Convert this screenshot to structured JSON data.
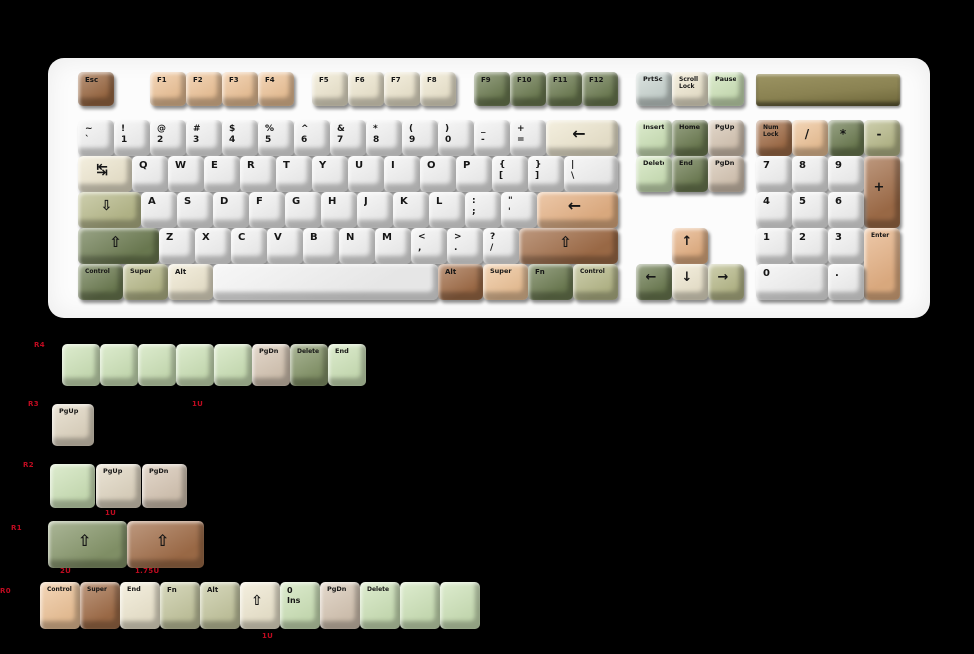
{
  "canvas": {
    "w": 974,
    "h": 654,
    "bg": "#000000"
  },
  "palette": {
    "white": "#f4f4f4",
    "cream": "#f0e9d2",
    "peach": "#efc59a",
    "tan": "#e6b285",
    "brown": "#a26e49",
    "dbrown": "#9c6a44",
    "dgreen": "#6f7e54",
    "mgreen": "#87976b",
    "sage": "#b9bb8c",
    "sage2": "#c7c9a2",
    "mint": "#cfe4ba",
    "taupe": "#d8c8b6",
    "sand": "#e2d8c4",
    "bluegray": "#ccd7d3",
    "legend": "#161616",
    "annotation_red": "#c00b20",
    "case": "#fcfcfc",
    "badge": "#8a8252"
  },
  "keyboard": {
    "case": {
      "x": 48,
      "y": 58,
      "w": 882,
      "h": 260
    },
    "badge": {
      "x": 756,
      "y": 74,
      "w": 144,
      "h": 32
    },
    "keys": [
      [
        78,
        72,
        36,
        34,
        "dbrown",
        "Esc",
        "",
        7,
        "esc"
      ],
      [
        150,
        72,
        36,
        34,
        "peach",
        "F1",
        "",
        7
      ],
      [
        186,
        72,
        36,
        34,
        "peach",
        "F2",
        "",
        7
      ],
      [
        222,
        72,
        36,
        34,
        "peach",
        "F3",
        "",
        7
      ],
      [
        258,
        72,
        36,
        34,
        "peach",
        "F4",
        "",
        7
      ],
      [
        312,
        72,
        36,
        34,
        "cream",
        "F5",
        "",
        7
      ],
      [
        348,
        72,
        36,
        34,
        "cream",
        "F6",
        "",
        7
      ],
      [
        384,
        72,
        36,
        34,
        "cream",
        "F7",
        "",
        7
      ],
      [
        420,
        72,
        36,
        34,
        "cream",
        "F8",
        "",
        7
      ],
      [
        474,
        72,
        36,
        34,
        "dgreen",
        "F9",
        "",
        7
      ],
      [
        510,
        72,
        36,
        34,
        "dgreen",
        "F10",
        "",
        7
      ],
      [
        546,
        72,
        36,
        34,
        "dgreen",
        "F11",
        "",
        7
      ],
      [
        582,
        72,
        36,
        34,
        "dgreen",
        "F12",
        "",
        7
      ],
      [
        636,
        72,
        36,
        34,
        "bluegray",
        "PrtSc",
        "",
        6.5,
        "print-screen"
      ],
      [
        672,
        72,
        36,
        34,
        "cream",
        "Scroll\nLock",
        "",
        6,
        "scroll-lock"
      ],
      [
        708,
        72,
        36,
        34,
        "mint",
        "Pause",
        "",
        6.5,
        "pause"
      ],
      [
        78,
        120,
        36,
        36,
        "white",
        "~\n`",
        "",
        9,
        "grave"
      ],
      [
        114,
        120,
        36,
        36,
        "white",
        "!\n1",
        "",
        9
      ],
      [
        150,
        120,
        36,
        36,
        "white",
        "@\n2",
        "",
        9
      ],
      [
        186,
        120,
        36,
        36,
        "white",
        "#\n3",
        "",
        9
      ],
      [
        222,
        120,
        36,
        36,
        "white",
        "$\n4",
        "",
        9
      ],
      [
        258,
        120,
        36,
        36,
        "white",
        "%\n5",
        "",
        9
      ],
      [
        294,
        120,
        36,
        36,
        "white",
        "^\n6",
        "",
        9
      ],
      [
        330,
        120,
        36,
        36,
        "white",
        "&\n7",
        "",
        9
      ],
      [
        366,
        120,
        36,
        36,
        "white",
        "*\n8",
        "",
        9
      ],
      [
        402,
        120,
        36,
        36,
        "white",
        "(\n9",
        "",
        9
      ],
      [
        438,
        120,
        36,
        36,
        "white",
        ")\n0",
        "",
        9
      ],
      [
        474,
        120,
        36,
        36,
        "white",
        "_\n-",
        "",
        9,
        "minus"
      ],
      [
        510,
        120,
        36,
        36,
        "white",
        "+\n=",
        "",
        9,
        "equals"
      ],
      [
        546,
        120,
        72,
        36,
        "cream",
        "←",
        "c",
        16,
        "backspace"
      ],
      [
        636,
        120,
        36,
        36,
        "mint",
        "Insert",
        "",
        6.5
      ],
      [
        672,
        120,
        36,
        36,
        "dgreen",
        "Home",
        "",
        6.5
      ],
      [
        708,
        120,
        36,
        36,
        "taupe",
        "PgUp",
        "",
        6.5
      ],
      [
        756,
        120,
        36,
        36,
        "brown",
        "Num\nLock",
        "",
        6,
        "num-lock"
      ],
      [
        792,
        120,
        36,
        36,
        "peach",
        "/",
        "c",
        12,
        "numpad-slash"
      ],
      [
        828,
        120,
        36,
        36,
        "dgreen",
        "*",
        "c",
        12,
        "numpad-star"
      ],
      [
        864,
        120,
        36,
        36,
        "sage",
        "-",
        "c",
        12,
        "numpad-minus"
      ],
      [
        78,
        156,
        54,
        36,
        "cream",
        "↹",
        "c",
        14,
        "tab"
      ],
      [
        132,
        156,
        36,
        36,
        "white",
        "Q",
        "",
        10
      ],
      [
        168,
        156,
        36,
        36,
        "white",
        "W",
        "",
        10
      ],
      [
        204,
        156,
        36,
        36,
        "white",
        "E",
        "",
        10
      ],
      [
        240,
        156,
        36,
        36,
        "white",
        "R",
        "",
        10
      ],
      [
        276,
        156,
        36,
        36,
        "white",
        "T",
        "",
        10
      ],
      [
        312,
        156,
        36,
        36,
        "white",
        "Y",
        "",
        10
      ],
      [
        348,
        156,
        36,
        36,
        "white",
        "U",
        "",
        10
      ],
      [
        384,
        156,
        36,
        36,
        "white",
        "I",
        "",
        10
      ],
      [
        420,
        156,
        36,
        36,
        "white",
        "O",
        "",
        10
      ],
      [
        456,
        156,
        36,
        36,
        "white",
        "P",
        "",
        10
      ],
      [
        492,
        156,
        36,
        36,
        "white",
        "{\n[",
        "",
        9,
        "lbracket"
      ],
      [
        528,
        156,
        36,
        36,
        "white",
        "}\n]",
        "",
        9,
        "rbracket"
      ],
      [
        564,
        156,
        54,
        36,
        "white",
        "|\n\\",
        "",
        9,
        "backslash"
      ],
      [
        636,
        156,
        36,
        36,
        "mint",
        "Delete",
        "",
        6.5
      ],
      [
        672,
        156,
        36,
        36,
        "dgreen",
        "End",
        "",
        6.5
      ],
      [
        708,
        156,
        36,
        36,
        "taupe",
        "PgDn",
        "",
        6.5
      ],
      [
        756,
        156,
        36,
        36,
        "white",
        "7",
        "",
        10,
        "numpad-7"
      ],
      [
        792,
        156,
        36,
        36,
        "white",
        "8",
        "",
        10,
        "numpad-8"
      ],
      [
        828,
        156,
        36,
        36,
        "white",
        "9",
        "",
        10,
        "numpad-9"
      ],
      [
        864,
        156,
        36,
        72,
        "brown",
        "+",
        "c",
        13,
        "numpad-plus"
      ],
      [
        78,
        192,
        63,
        36,
        "sage",
        "⇩",
        "c",
        14,
        "caps-lock"
      ],
      [
        141,
        192,
        36,
        36,
        "white",
        "A",
        "",
        10
      ],
      [
        177,
        192,
        36,
        36,
        "white",
        "S",
        "",
        10
      ],
      [
        213,
        192,
        36,
        36,
        "white",
        "D",
        "",
        10
      ],
      [
        249,
        192,
        36,
        36,
        "white",
        "F",
        "",
        10
      ],
      [
        285,
        192,
        36,
        36,
        "white",
        "G",
        "",
        10
      ],
      [
        321,
        192,
        36,
        36,
        "white",
        "H",
        "",
        10
      ],
      [
        357,
        192,
        36,
        36,
        "white",
        "J",
        "",
        10
      ],
      [
        393,
        192,
        36,
        36,
        "white",
        "K",
        "",
        10
      ],
      [
        429,
        192,
        36,
        36,
        "white",
        "L",
        "",
        10
      ],
      [
        465,
        192,
        36,
        36,
        "white",
        ":\n;",
        "",
        9,
        "semicolon"
      ],
      [
        501,
        192,
        36,
        36,
        "white",
        "\"\n'",
        "",
        9,
        "quote"
      ],
      [
        537,
        192,
        81,
        36,
        "tan",
        "←",
        "c",
        16,
        "enter"
      ],
      [
        756,
        192,
        36,
        36,
        "white",
        "4",
        "",
        10,
        "numpad-4"
      ],
      [
        792,
        192,
        36,
        36,
        "white",
        "5",
        "",
        10,
        "numpad-5"
      ],
      [
        828,
        192,
        36,
        36,
        "white",
        "6",
        "",
        10,
        "numpad-6"
      ],
      [
        78,
        228,
        81,
        36,
        "dgreen",
        "⇧",
        "c",
        15,
        "left-shift"
      ],
      [
        159,
        228,
        36,
        36,
        "white",
        "Z",
        "",
        10
      ],
      [
        195,
        228,
        36,
        36,
        "white",
        "X",
        "",
        10
      ],
      [
        231,
        228,
        36,
        36,
        "white",
        "C",
        "",
        10
      ],
      [
        267,
        228,
        36,
        36,
        "white",
        "V",
        "",
        10
      ],
      [
        303,
        228,
        36,
        36,
        "white",
        "B",
        "",
        10
      ],
      [
        339,
        228,
        36,
        36,
        "white",
        "N",
        "",
        10
      ],
      [
        375,
        228,
        36,
        36,
        "white",
        "M",
        "",
        10
      ],
      [
        411,
        228,
        36,
        36,
        "white",
        "<\n,",
        "",
        9,
        "comma"
      ],
      [
        447,
        228,
        36,
        36,
        "white",
        ">\n.",
        "",
        9,
        "period"
      ],
      [
        483,
        228,
        36,
        36,
        "white",
        "?\n/",
        "",
        9,
        "slash"
      ],
      [
        519,
        228,
        99,
        36,
        "brown",
        "⇧",
        "c",
        15,
        "right-shift"
      ],
      [
        672,
        228,
        36,
        36,
        "tan",
        "↑",
        "c",
        13,
        "arrow-up"
      ],
      [
        756,
        228,
        36,
        36,
        "white",
        "1",
        "",
        10,
        "numpad-1"
      ],
      [
        792,
        228,
        36,
        36,
        "white",
        "2",
        "",
        10,
        "numpad-2"
      ],
      [
        828,
        228,
        36,
        36,
        "white",
        "3",
        "",
        10,
        "numpad-3"
      ],
      [
        864,
        228,
        36,
        72,
        "tan",
        "Enter",
        "",
        6,
        "numpad-enter"
      ],
      [
        78,
        264,
        45,
        36,
        "dgreen",
        "Control",
        "",
        6,
        "left-control"
      ],
      [
        123,
        264,
        45,
        36,
        "sage",
        "Super",
        "",
        6.5,
        "left-super"
      ],
      [
        168,
        264,
        45,
        36,
        "cream",
        "Alt",
        "",
        7,
        "left-alt"
      ],
      [
        213,
        264,
        225,
        36,
        "white",
        "",
        "",
        8,
        "spacebar"
      ],
      [
        438,
        264,
        45,
        36,
        "brown",
        "Alt",
        "",
        7,
        "right-alt"
      ],
      [
        483,
        264,
        45,
        36,
        "peach",
        "Super",
        "",
        6.5,
        "right-super"
      ],
      [
        528,
        264,
        45,
        36,
        "dgreen",
        "Fn",
        "",
        7,
        "fn"
      ],
      [
        573,
        264,
        45,
        36,
        "sage",
        "Control",
        "",
        6,
        "right-control"
      ],
      [
        636,
        264,
        36,
        36,
        "dgreen",
        "←",
        "c",
        13,
        "arrow-left"
      ],
      [
        672,
        264,
        36,
        36,
        "cream",
        "↓",
        "c",
        13,
        "arrow-down"
      ],
      [
        708,
        264,
        36,
        36,
        "sage",
        "→",
        "c",
        13,
        "arrow-right"
      ],
      [
        756,
        264,
        72,
        36,
        "white",
        "0",
        "",
        10,
        "numpad-0"
      ],
      [
        828,
        264,
        36,
        36,
        "white",
        ".",
        "",
        10,
        "numpad-dot"
      ]
    ]
  },
  "extras": {
    "rows": [
      {
        "row_label": "R4",
        "keys": [
          [
            62,
            344,
            38,
            42,
            "mint",
            "",
            "",
            8,
            "blank"
          ],
          [
            100,
            344,
            38,
            42,
            "mint",
            "",
            "",
            8,
            "blank"
          ],
          [
            138,
            344,
            38,
            42,
            "mint",
            "",
            "",
            8,
            "blank"
          ],
          [
            176,
            344,
            38,
            42,
            "mint",
            "",
            "",
            8,
            "blank"
          ],
          [
            214,
            344,
            38,
            42,
            "mint",
            "",
            "",
            8,
            "blank"
          ],
          [
            252,
            344,
            38,
            42,
            "taupe",
            "PgDn",
            "",
            6.5
          ],
          [
            290,
            344,
            38,
            42,
            "mgreen",
            "Delete",
            "",
            6
          ],
          [
            328,
            344,
            38,
            42,
            "mint",
            "End",
            "",
            6.5
          ]
        ]
      },
      {
        "row_label": "R3",
        "keys": [
          [
            52,
            404,
            42,
            42,
            "sand",
            "PgUp",
            "",
            6.5
          ]
        ]
      },
      {
        "row_label": "R2",
        "keys": [
          [
            50,
            464,
            45,
            44,
            "mint",
            "",
            "",
            8,
            "blank"
          ],
          [
            96,
            464,
            45,
            44,
            "sand",
            "PgUp",
            "",
            6.5
          ],
          [
            142,
            464,
            45,
            44,
            "taupe",
            "PgDn",
            "",
            6.5
          ]
        ]
      },
      {
        "row_label": "R1",
        "keys": [
          [
            48,
            521,
            79,
            47,
            "mgreen",
            "⇧",
            "c",
            16,
            "shift-2u"
          ],
          [
            127,
            521,
            77,
            47,
            "brown",
            "⇧",
            "c",
            16,
            "shift-175u"
          ]
        ]
      },
      {
        "row_label": "R0",
        "keys": [
          [
            40,
            582,
            40,
            47,
            "peach",
            "Control",
            "",
            6
          ],
          [
            80,
            582,
            40,
            47,
            "brown",
            "Super",
            "",
            6
          ],
          [
            120,
            582,
            40,
            47,
            "cream",
            "End",
            "",
            6.5
          ],
          [
            160,
            582,
            40,
            47,
            "sage2",
            "Fn",
            "",
            7
          ],
          [
            200,
            582,
            40,
            47,
            "sage2",
            "Alt",
            "",
            7
          ],
          [
            240,
            582,
            40,
            47,
            "cream",
            "⇧",
            "c",
            14,
            "shift-1u"
          ],
          [
            280,
            582,
            40,
            47,
            "mint",
            "0\nIns",
            "",
            8,
            "0-ins"
          ],
          [
            320,
            582,
            40,
            47,
            "taupe",
            "PgDn",
            "",
            6.5
          ],
          [
            360,
            582,
            40,
            47,
            "mint",
            "Delete",
            "",
            6
          ],
          [
            400,
            582,
            40,
            47,
            "mint",
            "",
            "",
            8,
            "blank"
          ],
          [
            440,
            582,
            40,
            47,
            "mint",
            "",
            "",
            8,
            "blank"
          ]
        ]
      }
    ],
    "annotations": [
      {
        "x": 34,
        "y": 341,
        "t": "R4"
      },
      {
        "x": 28,
        "y": 400,
        "t": "R3"
      },
      {
        "x": 192,
        "y": 400,
        "t": "1U"
      },
      {
        "x": 23,
        "y": 461,
        "t": "R2"
      },
      {
        "x": 105,
        "y": 509,
        "t": "1U"
      },
      {
        "x": 11,
        "y": 524,
        "t": "R1"
      },
      {
        "x": 60,
        "y": 567,
        "t": "2U"
      },
      {
        "x": 135,
        "y": 567,
        "t": "1.75U"
      },
      {
        "x": 0,
        "y": 587,
        "t": "R0"
      },
      {
        "x": 262,
        "y": 632,
        "t": "1U"
      }
    ]
  }
}
